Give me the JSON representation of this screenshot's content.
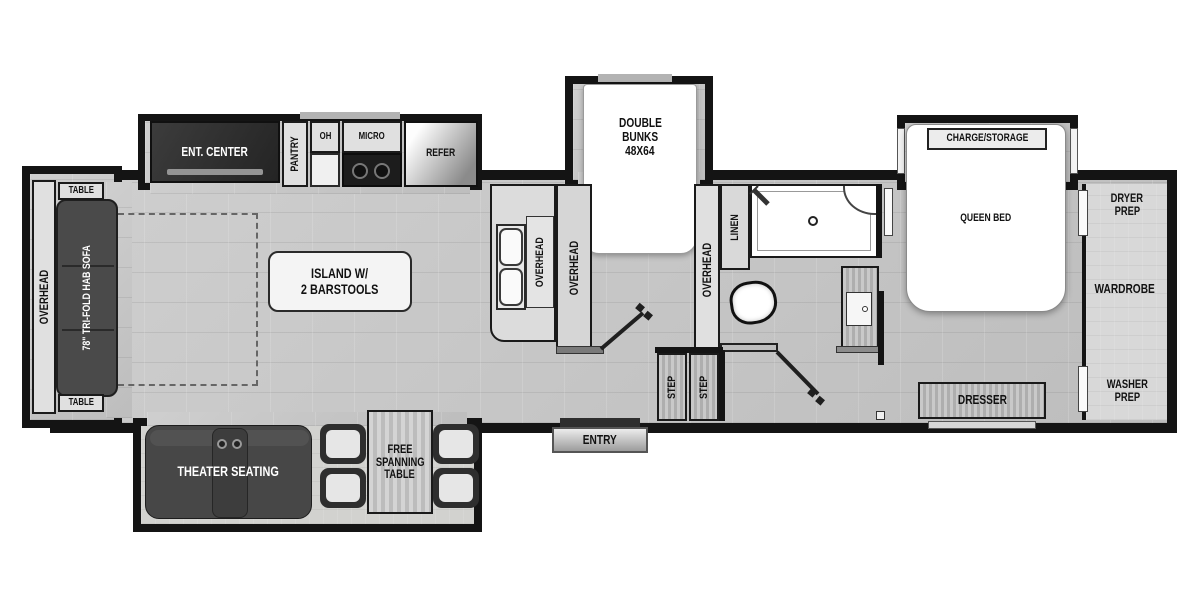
{
  "type": "rv-fifth-wheel-floorplan",
  "colors": {
    "wall": "#141414",
    "floor": "#c9c9c9",
    "cabinet": "#e0e0e0",
    "dark_furniture": "#474747",
    "wood": "#b5b5b5",
    "fixture_white": "#ffffff"
  },
  "slides": {
    "rear": {
      "overhead": "OVERHEAD",
      "table_top": "TABLE",
      "table_bottom": "TABLE",
      "sofa": "78\" TRI-FOLD HAB SOFA"
    },
    "kitchen": {
      "ent_center": "ENT. CENTER",
      "pantry": "PANTRY",
      "oh": "OH",
      "micro": "MICRO",
      "refer": "REFER"
    },
    "bunks": {
      "line1": "DOUBLE",
      "line2": "BUNKS",
      "line3": "48X64"
    },
    "bedroom": {
      "charge_storage": "CHARGE/STORAGE"
    },
    "living_bottom": {
      "theater": "THEATER SEATING",
      "table_line1": "FREE",
      "table_line2": "SPANNING",
      "table_line3": "TABLE"
    }
  },
  "kitchen": {
    "sink_overhead": "OVERHEAD",
    "counter_overhead": "OVERHEAD",
    "island_line1": "ISLAND W/",
    "island_line2": "2 BARSTOOLS"
  },
  "bunkroom": {
    "overhead_right": "OVERHEAD"
  },
  "bath": {
    "linen": "LINEN"
  },
  "hall": {
    "step_1": "STEP",
    "step_2": "STEP",
    "entry": "ENTRY"
  },
  "bedroom": {
    "queen": "QUEEN BED",
    "dresser": "DRESSER",
    "dryer_line1": "DRYER",
    "dryer_line2": "PREP",
    "wardrobe": "WARDROBE",
    "washer_line1": "WASHER",
    "washer_line2": "PREP"
  }
}
